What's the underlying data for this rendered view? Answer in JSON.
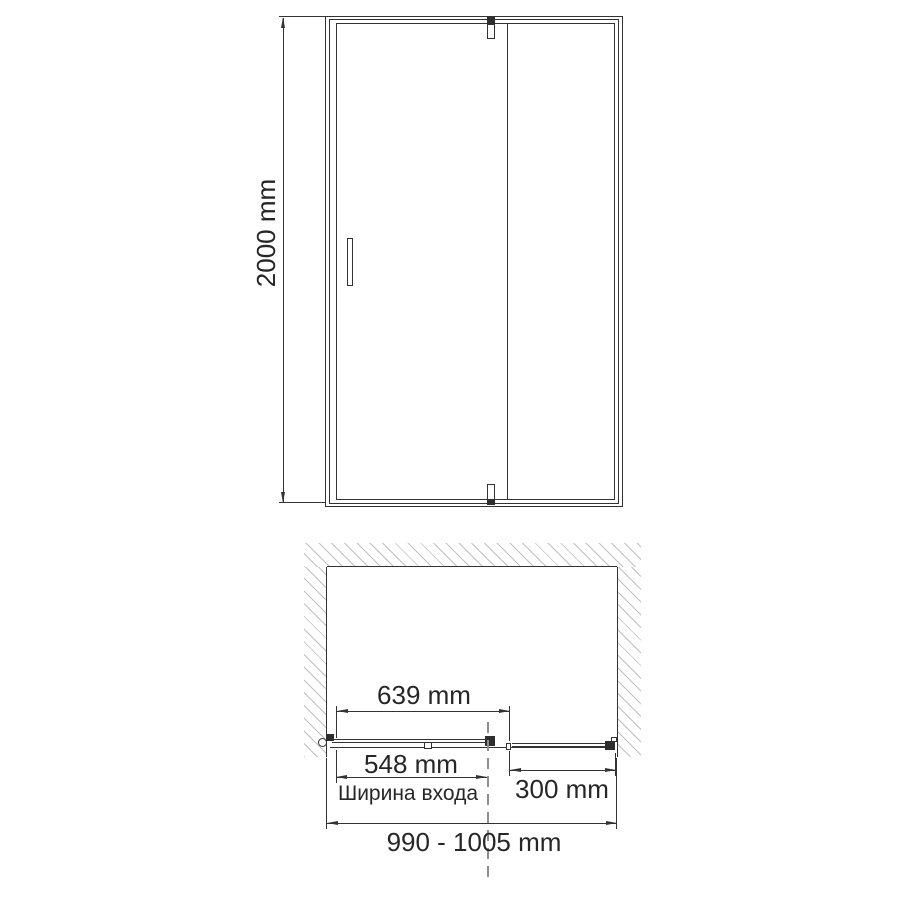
{
  "drawing": {
    "front_view": {
      "height_dim": "2000 mm"
    },
    "plan_view": {
      "door_width_dim": "639 mm",
      "entrance_width_dim": "548 mm",
      "entrance_caption": "Ширина входа",
      "fixed_width_dim": "300 mm",
      "total_width_dim": "990 - 1005 mm"
    },
    "colors": {
      "line": "#333333",
      "text": "#262626",
      "hatch": "#c0c0c0",
      "centerline": "#8e8e8e"
    }
  }
}
